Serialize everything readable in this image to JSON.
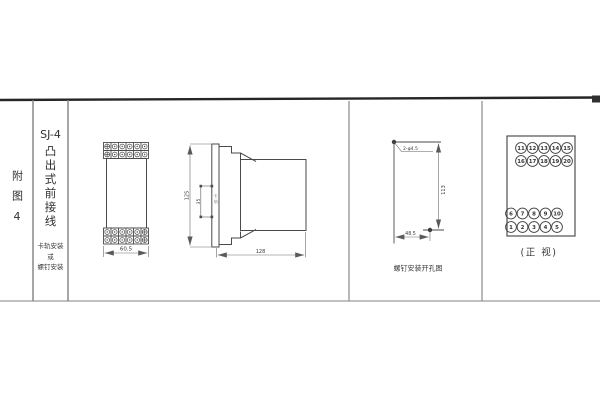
{
  "colors": {
    "line": "#4a4a4a",
    "dim_line": "#666666",
    "table_line": "#8a8a8a",
    "top_border": "#262626",
    "text": "#383838",
    "bg": "#ffffff"
  },
  "figure": {
    "index_label": "附图4",
    "model": "SJ-4",
    "type_vertical": "凸出式前接线",
    "mount_lines": [
      "卡轨安装",
      "或",
      "螺钉安装"
    ]
  },
  "front_view": {
    "width_dim": "60.5"
  },
  "side_view": {
    "height_dim": "125",
    "rail_dim": "35",
    "rail_label_chars": [
      "卡",
      "轨"
    ],
    "depth_dim": "128"
  },
  "drill_plan": {
    "holes_label": "2-φ4.5",
    "vertical_dim": "113",
    "horizontal_dim": "48.5",
    "caption": "螺钉安装开孔图"
  },
  "terminal_view": {
    "caption": "(正 视)",
    "rows": [
      [
        "11",
        "12",
        "13",
        "14",
        "15"
      ],
      [
        "16",
        "17",
        "18",
        "19",
        "20"
      ],
      [
        "6",
        "7",
        "8",
        "9",
        "10"
      ],
      [
        "1",
        "2",
        "3",
        "4",
        "5"
      ]
    ]
  }
}
